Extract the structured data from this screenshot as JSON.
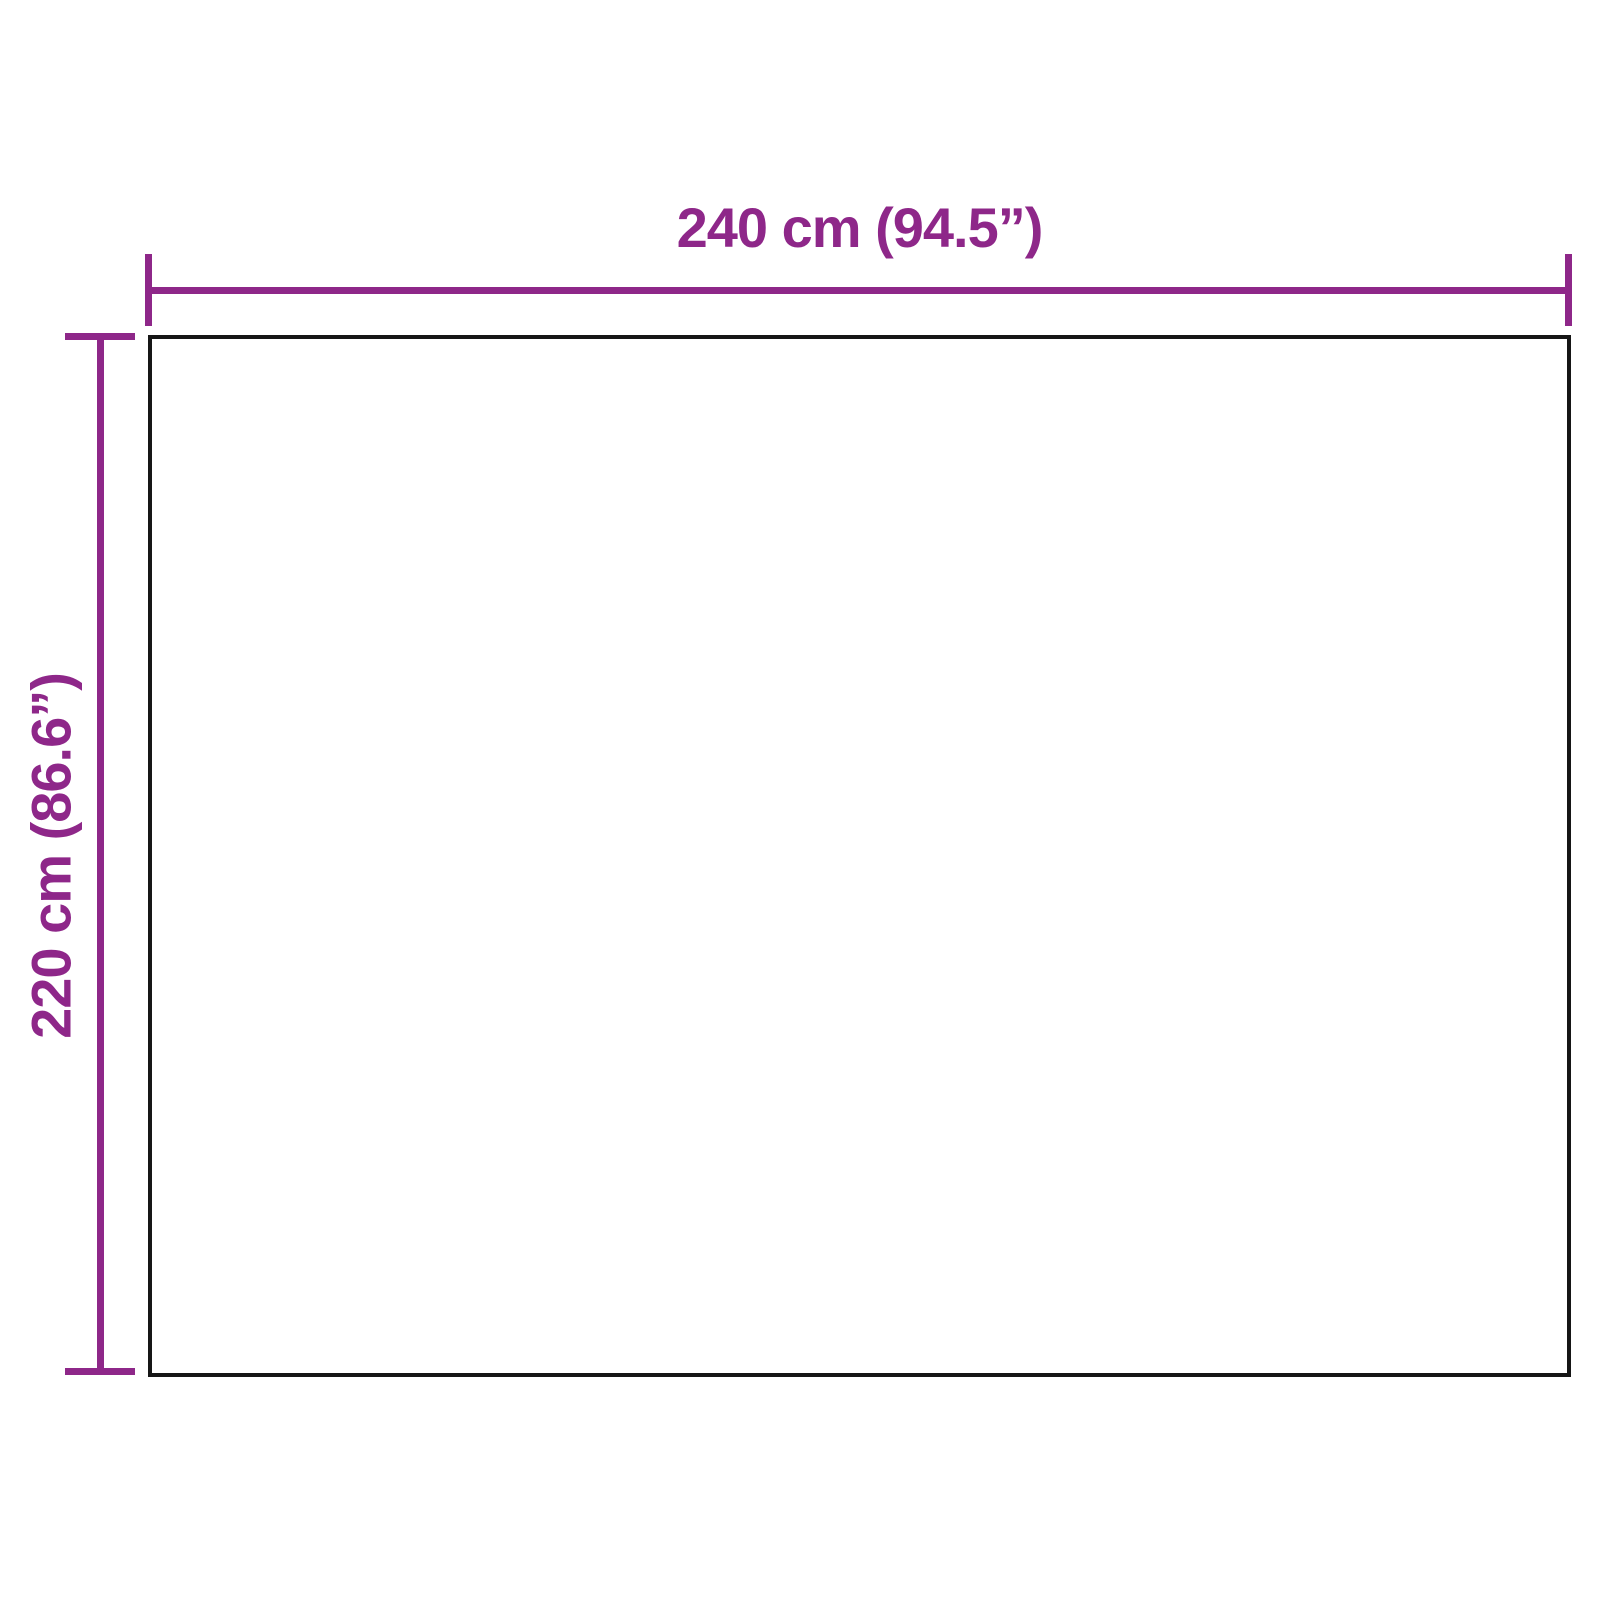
{
  "diagram": {
    "type": "dimension-drawing",
    "shape": "rectangle",
    "width_dimension": {
      "label": "240 cm (94.5”)",
      "cm": "240",
      "inches": "94.5"
    },
    "height_dimension": {
      "label": "220 cm (86.6”)",
      "cm": "220",
      "inches": "86.6"
    },
    "colors": {
      "dimension_accent": "#8E2789",
      "outline": "#161616",
      "background": "#FFFFFF"
    }
  }
}
